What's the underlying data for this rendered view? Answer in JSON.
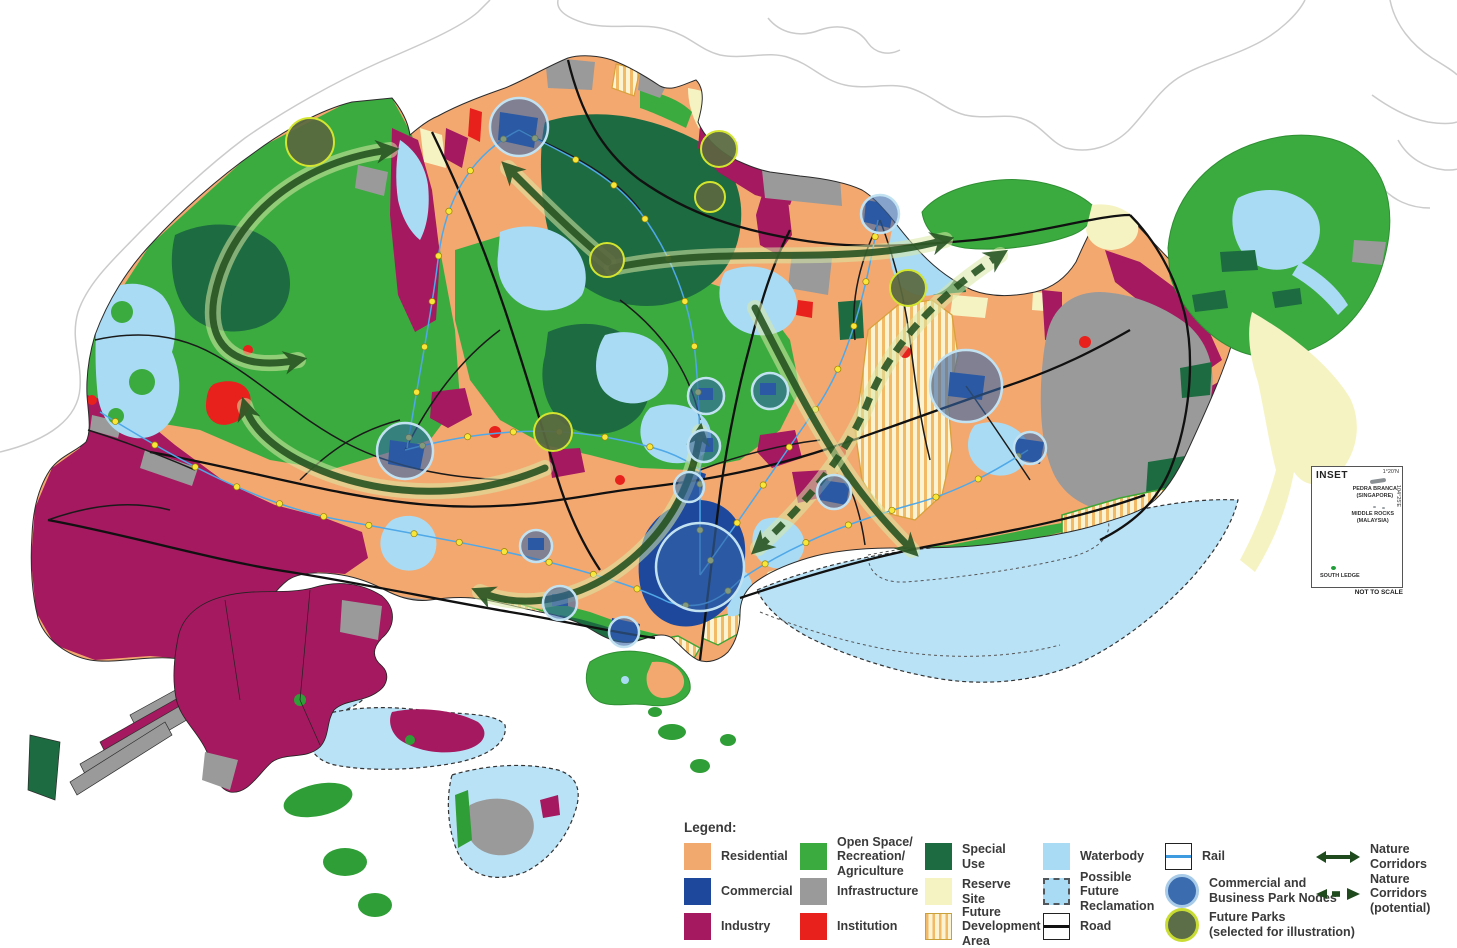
{
  "map": {
    "inset": {
      "title": "INSET",
      "pedra_branca_label": "PEDRA BRANCA\n(SINGAPORE)",
      "middle_rocks_label": "MIDDLE ROCKS\n(MALAYSIA)",
      "south_ledge_label": "SOUTH LEDGE",
      "latitude_label": "1°20'N",
      "longitude_label": "104°25'E",
      "scale_note": "NOT TO SCALE"
    }
  },
  "legend": {
    "title": "Legend:",
    "items": [
      {
        "label": "Residential",
        "icon": "residential-swatch",
        "color": "#F2A96E"
      },
      {
        "label": "Commercial",
        "icon": "commercial-swatch",
        "color": "#1E489B"
      },
      {
        "label": "Industry",
        "icon": "industry-swatch",
        "color": "#A4195F"
      },
      {
        "label": "Open Space/\nRecreation/\nAgriculture",
        "icon": "open-space-swatch",
        "color": "#3BAB3F"
      },
      {
        "label": "Infrastructure",
        "icon": "infrastructure-swatch",
        "color": "#9A9A9A"
      },
      {
        "label": "Institution",
        "icon": "institution-swatch",
        "color": "#E8211D"
      },
      {
        "label": "Special\nUse",
        "icon": "special-use-swatch",
        "color": "#1D6B40"
      },
      {
        "label": "Reserve\nSite",
        "icon": "reserve-site-swatch",
        "color": "#F6F3C3"
      },
      {
        "label": "Future\nDevelopment\nArea",
        "icon": "future-development-area-swatch",
        "color": "#F2B966"
      },
      {
        "label": "Waterbody",
        "icon": "waterbody-swatch",
        "color": "#A9DCF4"
      },
      {
        "label": "Possible\nFuture\nReclamation",
        "icon": "possible-future-reclamation-swatch",
        "color": "#A9DCF4"
      },
      {
        "label": "Road",
        "icon": "road-swatch",
        "color": "#000000"
      },
      {
        "label": "Rail",
        "icon": "rail-swatch",
        "color": "#3F9BE0"
      },
      {
        "label": "Commercial and\nBusiness Park Nodes",
        "icon": "business-park-node-swatch",
        "color": "#3C6CB0"
      },
      {
        "label": "Future Parks\n(selected for illustration)",
        "icon": "future-parks-swatch",
        "color": "#5C6E48"
      },
      {
        "label": "Nature Corridors",
        "icon": "nature-corridors-swatch",
        "color": "#24511F"
      },
      {
        "label": "Nature Corridors\n(potential)",
        "icon": "nature-corridors-potential-swatch",
        "color": "#24511F"
      }
    ]
  }
}
